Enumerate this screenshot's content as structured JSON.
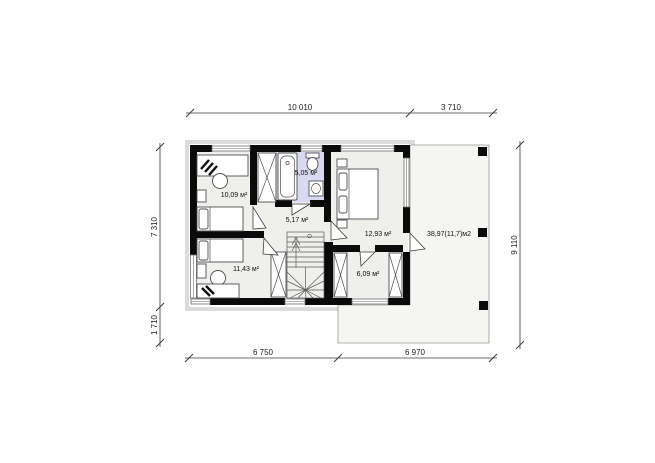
{
  "plan": {
    "type": "floor-plan",
    "rooms": {
      "bedroom_top_left": {
        "label": "10,09 м²"
      },
      "bathroom": {
        "label": "5,05 м²"
      },
      "hall": {
        "label": "5,17 м²"
      },
      "bedroom_right": {
        "label": "12,93 м²"
      },
      "bedroom_bottom_left": {
        "label": "11,43 м²"
      },
      "closet_room": {
        "label": "6,09 м²"
      },
      "terrace": {
        "label": "38,97(11,7)м2"
      }
    },
    "dimensions": {
      "top_main": "10 010",
      "top_terrace": "3 710",
      "left_main": "7 310",
      "left_lower": "1 710",
      "right_total": "9 110",
      "bottom_main": "6 750",
      "bottom_terrace": "6 970"
    },
    "colors": {
      "wall": "#0a0a0a",
      "floor": "#efefec",
      "bathroom_floor": "#d9daf1",
      "terrace_floor": "#f5f5f2",
      "furniture_stroke": "#4f4f4f",
      "dimension_text": "#222222"
    }
  }
}
